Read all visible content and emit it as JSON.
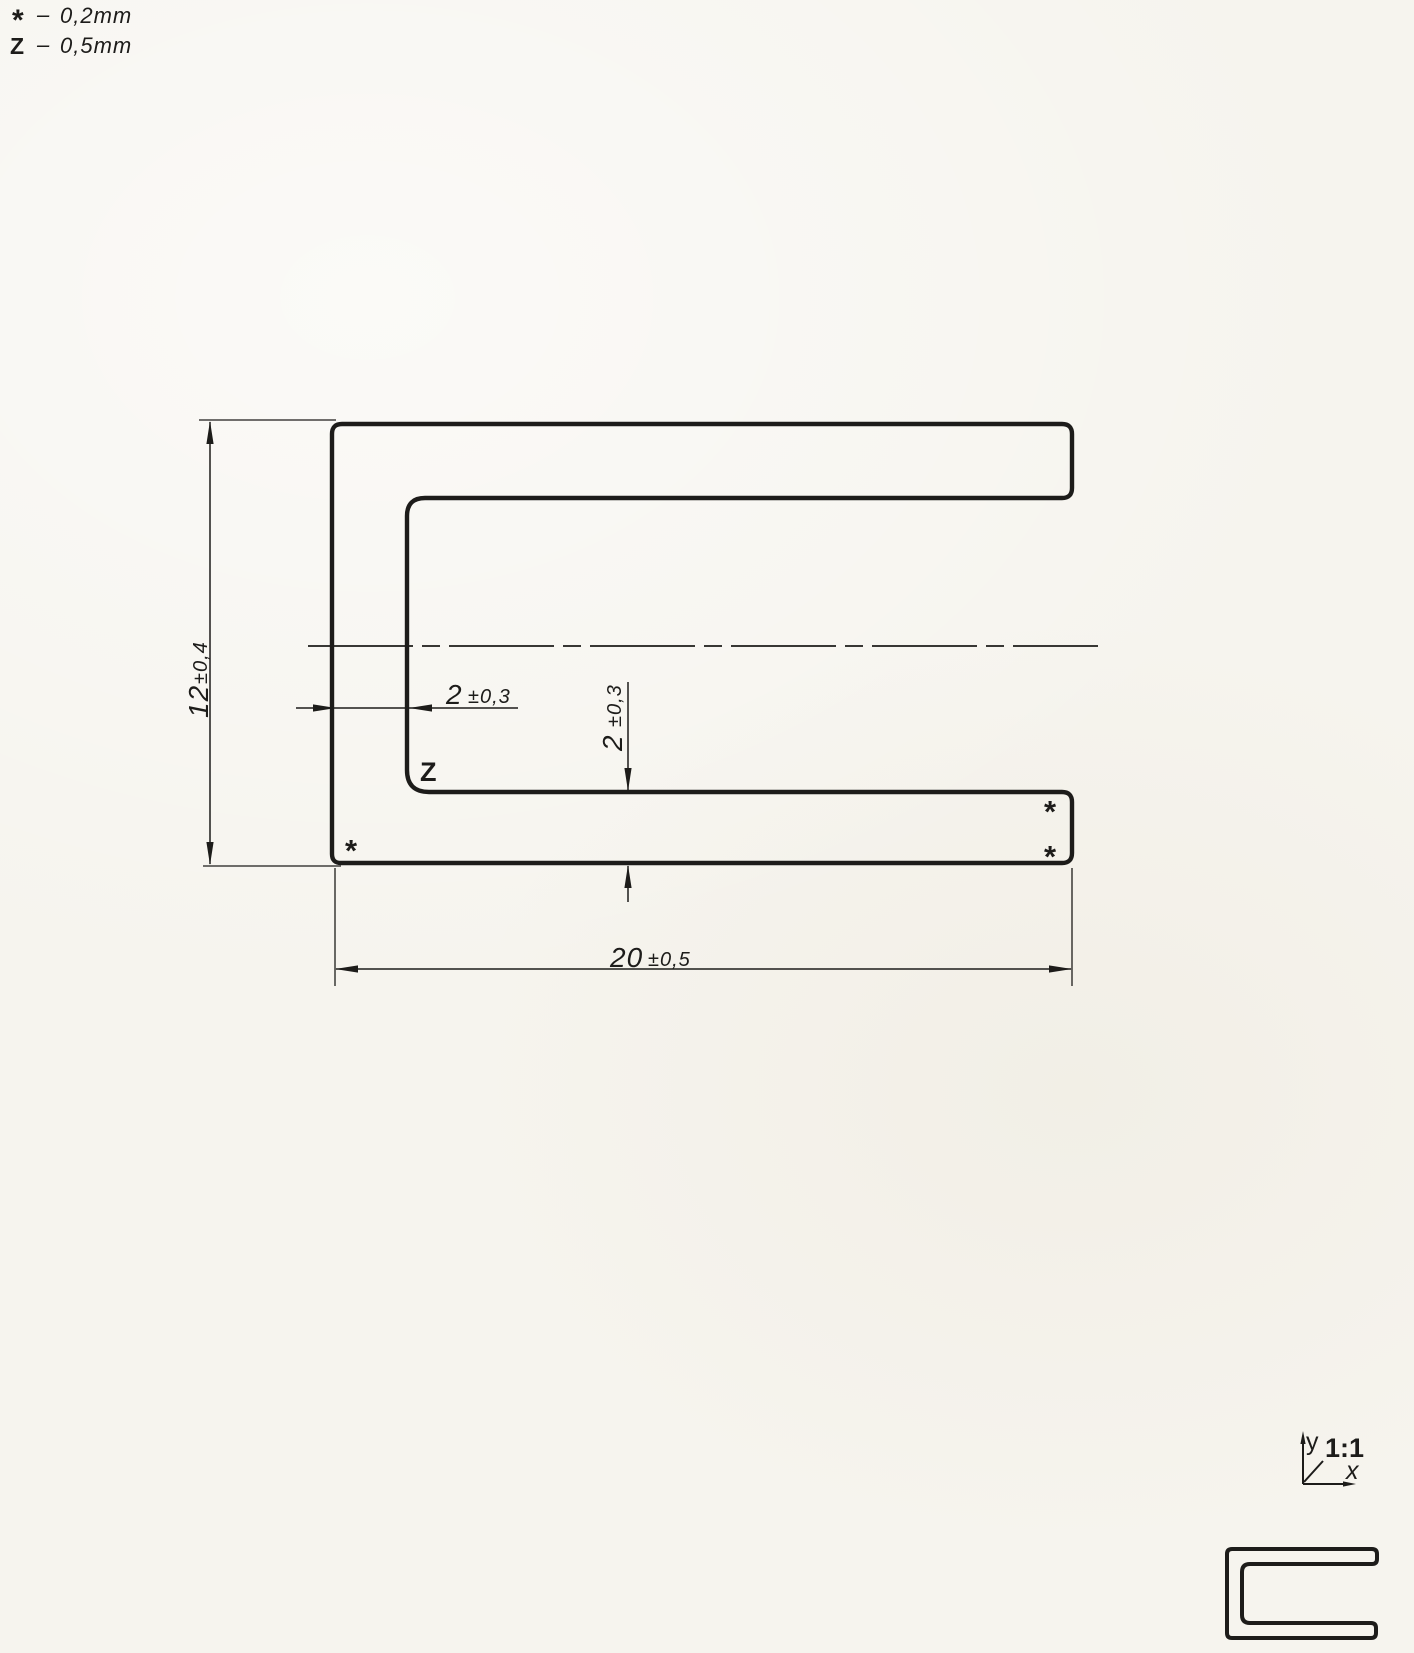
{
  "legend": {
    "line1": {
      "symbol": "*",
      "separator": "–",
      "value": "0,2mm"
    },
    "line2": {
      "symbol": "Z",
      "separator": "–",
      "value": "0,5mm"
    }
  },
  "dimensions": {
    "height": {
      "value": "12",
      "tol": "±0,4"
    },
    "wall": {
      "value": "2",
      "tol": "±0,3"
    },
    "flange": {
      "value": "2",
      "tol": "±0,3"
    },
    "width": {
      "value": "20",
      "tol": "±0,5"
    }
  },
  "labels": {
    "corner_z": "Z",
    "mark_left": "*",
    "mark_right_top": "*",
    "mark_right_bottom": "*"
  },
  "scale_block": {
    "axis_y": "y",
    "scale": "1:1",
    "axis_x": "x"
  },
  "colors": {
    "ink": "#1d1c1a",
    "paper": "#f6f4ee"
  }
}
